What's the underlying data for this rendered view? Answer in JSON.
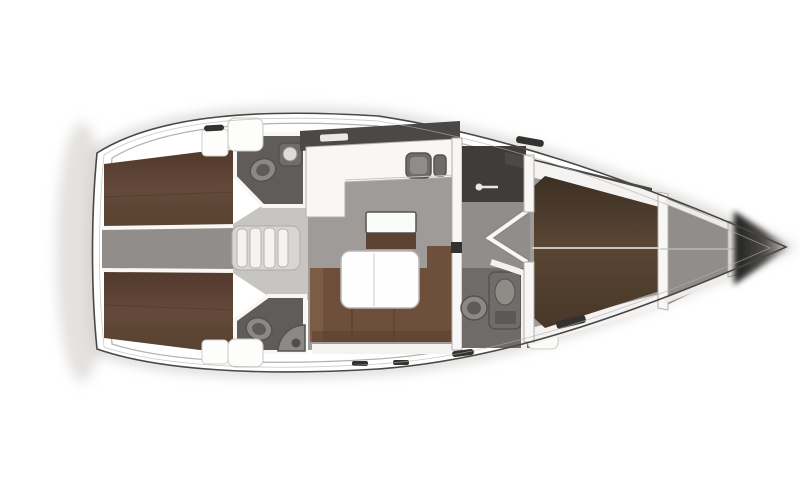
{
  "diagram": {
    "type": "yacht-interior-deck-plan",
    "orientation": "bow-right-stern-left",
    "visible_text": [],
    "colors": {
      "hull_outline": "#4a4846",
      "deck_white": "#ffffff",
      "shadow_soft": "#dcdad8",
      "floor_gray": "#9e9b98",
      "floor_light": "#c7c5c2",
      "floor_dark": "#55524f",
      "strip_gray": "#908d8a",
      "head_floor": "#5f5c59",
      "dark_room": "#3f3d3b",
      "berth_brown": "#5d4638",
      "sofa_brown": "#6e4f3b",
      "cabinet_brown": "#5b4233",
      "bed_brown": "#52402f",
      "fixture_gray": "#8b8885",
      "fixture_dark": "#6f6c69",
      "white_trim": "#f4f3f1",
      "wall_white": "#f8f7f5",
      "band_dark": "#4b4947",
      "slot_dark": "#34322f",
      "bow_dark": "#262524",
      "line_thin": "#b3b1af"
    },
    "areas": [
      {
        "id": "aft-cabin-port",
        "kind": "double-berth-cabin"
      },
      {
        "id": "aft-cabin-starboard",
        "kind": "double-berth-cabin"
      },
      {
        "id": "engine-passage",
        "kind": "engine-space"
      },
      {
        "id": "companionway-steps",
        "kind": "stairs"
      },
      {
        "id": "aft-head-port",
        "kind": "toilet-sink"
      },
      {
        "id": "aft-head-starboard",
        "kind": "toilet-sink"
      },
      {
        "id": "galley",
        "kind": "l-counter-double-sink"
      },
      {
        "id": "salon",
        "kind": "sofa-table-cabinet"
      },
      {
        "id": "forward-head",
        "kind": "toilet-shower"
      },
      {
        "id": "forward-cabin",
        "kind": "island-bed"
      },
      {
        "id": "bow-locker",
        "kind": "anchor-locker"
      }
    ],
    "fixtures": [
      "toilet",
      "sink",
      "double-sink",
      "shower-column",
      "salon-table",
      "l-sofa",
      "double-berth",
      "island-bed",
      "steps",
      "deck-hatch"
    ]
  }
}
